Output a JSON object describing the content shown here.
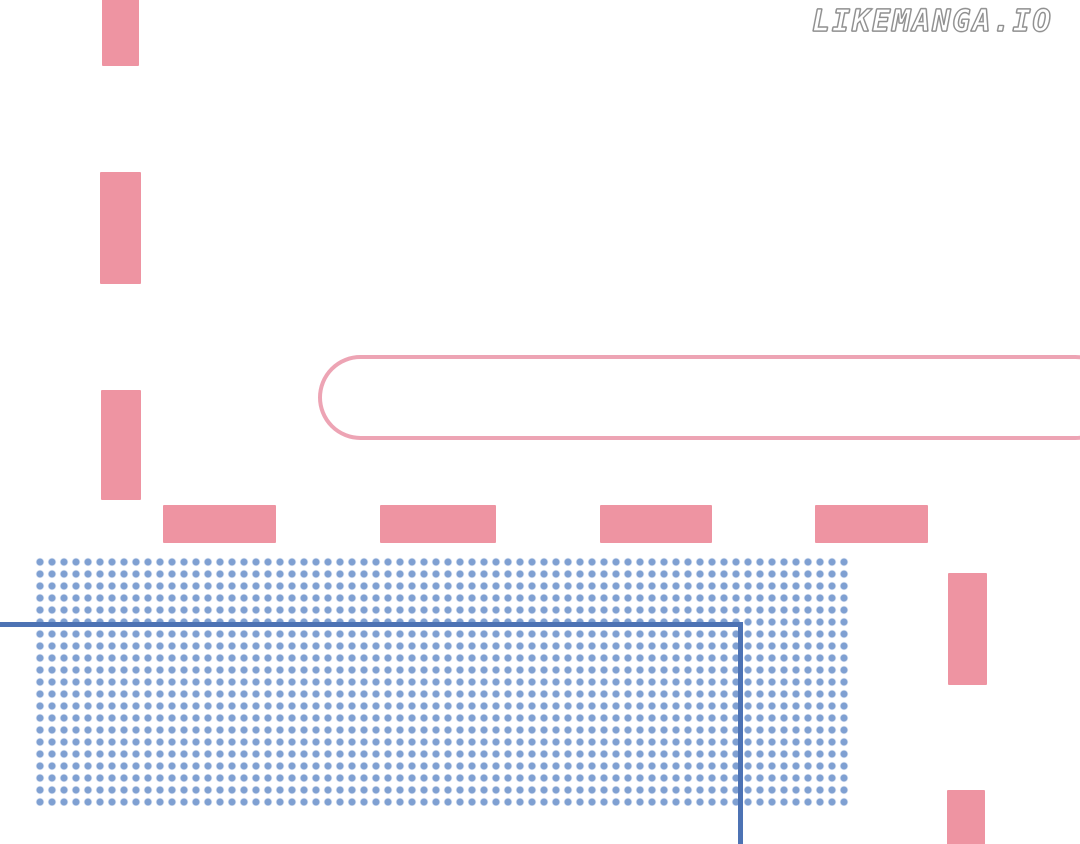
{
  "page": {
    "kind": "manga-page-scan",
    "background": "#ffffff"
  },
  "watermark": {
    "text": "LIKEMANGA.IO"
  },
  "colors": {
    "page_bg": "#ffffff",
    "pink": "#ee94a2",
    "pill_pink": "#eda4b4",
    "dot_blue": "#7fa0d2",
    "blue_line": "#4d73b4"
  },
  "artwork": {
    "elements": [
      "vertical pink dash top-left (clipped at top edge)",
      "vertical pink dash upper-left",
      "vertical pink dash mid-left",
      "horizontal pink dash row of four above dot block",
      "vertical pink dash right side upper",
      "vertical pink dash right side bottom (clipped at bottom edge)",
      "empty pill-shaped speech bubble outline running off right edge",
      "blue halftone dot screen-tone rectangle",
      "blue panel border corner line running off left and bottom edges"
    ]
  }
}
